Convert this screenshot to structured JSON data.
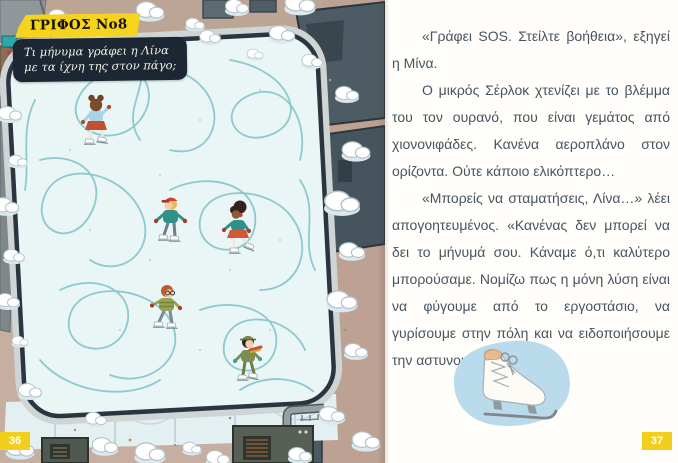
{
  "left_page": {
    "riddle_badge": "ΓΡΙΦΟΣ Νο8",
    "riddle_question": [
      "Τι μήνυμα γράφει η Λίνα",
      "με τα ίχνη της στον πάγο;"
    ],
    "page_number": "36"
  },
  "right_page": {
    "paragraphs": [
      "«Γράφει SOS. Στείλτε βοήθεια», εξηγεί η Μίνα.",
      "Ο μικρός Σέρλοκ χτενίζει με το βλέμμα του τον ουρανό, που είναι γεμάτος από χιονονιφάδες. Κανένα αεροπλάνο στον ορίζοντα. Ούτε κάποιο ελικόπτερο…",
      "«Μπορείς να σταματήσεις, Λίνα…» λέει απογοητευμένος. «Κανένας δεν μπορεί να δει το μήνυμά σου. Κάναμε ό,τι καλύτερο μπορούσαμε. Νομίζω πως η μόνη λύση είναι να φύγουμε από το εργοστάσιο, να γυρίσουμε στην πόλη και να ειδοποιήσουμε την αστυνομία…»"
    ],
    "page_number": "37"
  },
  "colors": {
    "accent_yellow": "#f6d31d",
    "question_box_navy": "#1d2733",
    "body_text": "#47545f",
    "ice": "#eaf5f6",
    "trail_teal": "#83c5c9",
    "rink_border_navy": "#2b3540",
    "ground_tan": "#c6aea0",
    "skate_blob_blue": "#b9dbec"
  }
}
